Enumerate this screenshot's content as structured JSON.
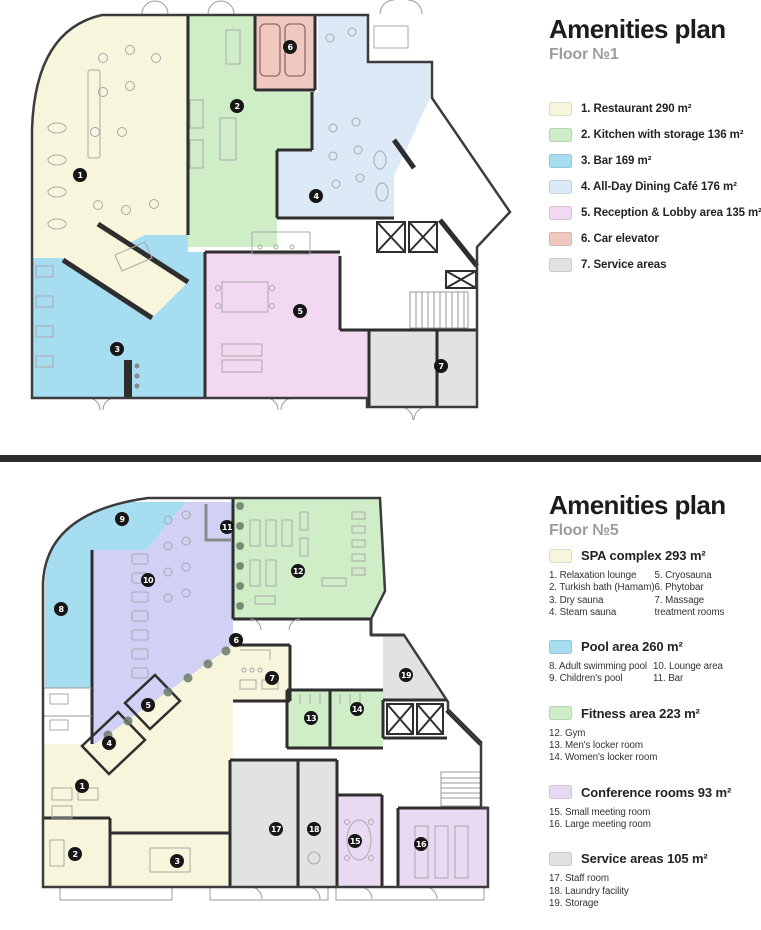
{
  "colors": {
    "restaurant": "#f7f6dc",
    "kitchen": "#cfeec8",
    "bar": "#a7ddf1",
    "cafe": "#dce9f6",
    "reception": "#f2d8f0",
    "car": "#f0c8c0",
    "service": "#e2e2e0",
    "spa": "#f7f6dc",
    "pool": "#a7ddf1",
    "lounge": "#d0d1f4",
    "fitness": "#cfeec8",
    "conference": "#ead9f3"
  },
  "plans": [
    {
      "title": "Amenities plan",
      "floor": "Floor №1",
      "legend": [
        {
          "label": "1. Restaurant 290 m²",
          "color": "#f7f6dc"
        },
        {
          "label": "2. Kitchen with storage 136 m²",
          "color": "#cfeec8"
        },
        {
          "label": "3. Bar 169 m²",
          "color": "#a7ddf1"
        },
        {
          "label": "4. All-Day Dining Café 176 m²",
          "color": "#dce9f6"
        },
        {
          "label": "5. Reception & Lobby area 135 m²",
          "color": "#f2d8f0"
        },
        {
          "label": "6. Car elevator",
          "color": "#f0c8c0"
        },
        {
          "label": "7. Service areas",
          "color": "#e2e2e0"
        }
      ],
      "markers": [
        {
          "n": "1",
          "x": 80,
          "y": 175
        },
        {
          "n": "2",
          "x": 237,
          "y": 106
        },
        {
          "n": "3",
          "x": 117,
          "y": 349
        },
        {
          "n": "4",
          "x": 316,
          "y": 196
        },
        {
          "n": "5",
          "x": 300,
          "y": 311
        },
        {
          "n": "6",
          "x": 290,
          "y": 47
        },
        {
          "n": "7",
          "x": 441,
          "y": 366
        }
      ]
    },
    {
      "title": "Amenities plan",
      "floor": "Floor №5",
      "groups": [
        {
          "label": "SPA complex 293 m²",
          "color": "#f7f6dc",
          "col1": [
            "1. Relaxation lounge",
            "2. Turkish bath (Hamam)",
            "3. Dry sauna",
            "4. Steam sauna"
          ],
          "col2": [
            "5. Cryosauna",
            "6. Phytobar",
            "7. Massage",
            "treatment rooms"
          ]
        },
        {
          "label": "Pool area 260 m²",
          "color": "#a7ddf1",
          "col1": [
            "8. Adult swimming pool",
            "9. Children's pool"
          ],
          "col2": [
            "10. Lounge area",
            "11. Bar"
          ]
        },
        {
          "label": "Fitness area 223 m²",
          "color": "#cfeec8",
          "col1": [
            "12. Gym",
            "13. Men's locker room",
            "14. Women's locker room"
          ],
          "col2": []
        },
        {
          "label": "Conference rooms 93 m²",
          "color": "#ead9f3",
          "col1": [
            "15. Small meeting room",
            "16. Large meeting room"
          ],
          "col2": []
        },
        {
          "label": "Service areas 105 m²",
          "color": "#e2e2e0",
          "col1": [
            "17. Staff room",
            "18. Laundry facility",
            "19. Storage"
          ],
          "col2": []
        }
      ],
      "markers": [
        {
          "n": "1",
          "x": 82,
          "y": 298
        },
        {
          "n": "2",
          "x": 75,
          "y": 366
        },
        {
          "n": "3",
          "x": 177,
          "y": 373
        },
        {
          "n": "4",
          "x": 109,
          "y": 255
        },
        {
          "n": "5",
          "x": 148,
          "y": 217
        },
        {
          "n": "6",
          "x": 236,
          "y": 152
        },
        {
          "n": "7",
          "x": 272,
          "y": 190
        },
        {
          "n": "8",
          "x": 61,
          "y": 121
        },
        {
          "n": "9",
          "x": 122,
          "y": 31
        },
        {
          "n": "10",
          "x": 148,
          "y": 92
        },
        {
          "n": "11",
          "x": 227,
          "y": 39
        },
        {
          "n": "12",
          "x": 298,
          "y": 83
        },
        {
          "n": "13",
          "x": 311,
          "y": 230
        },
        {
          "n": "14",
          "x": 357,
          "y": 221
        },
        {
          "n": "15",
          "x": 355,
          "y": 353
        },
        {
          "n": "16",
          "x": 421,
          "y": 356
        },
        {
          "n": "17",
          "x": 276,
          "y": 341
        },
        {
          "n": "18",
          "x": 314,
          "y": 341
        },
        {
          "n": "19",
          "x": 406,
          "y": 187
        }
      ]
    }
  ]
}
